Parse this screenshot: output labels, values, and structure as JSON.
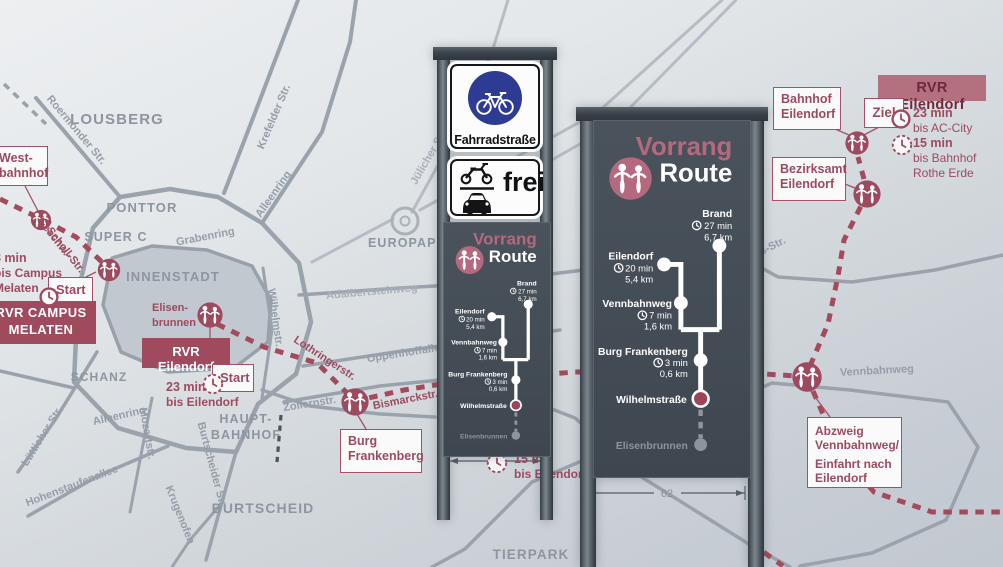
{
  "route": {
    "title_line1": "Vorrang",
    "title_line2": "Route",
    "stops": [
      {
        "name": "Brand",
        "time": "27 min",
        "dist": "6,7 km"
      },
      {
        "name": "Eilendorf",
        "time": "20 min",
        "dist": "5,4 km"
      },
      {
        "name": "Vennbahnweg",
        "time": "7 min",
        "dist": "1,6 km"
      },
      {
        "name": "Burg Frankenberg",
        "time": "3 min",
        "dist": "0,6 km"
      },
      {
        "name": "Wilhelmstraße"
      },
      {
        "name": "Elisenbrunnen"
      }
    ]
  },
  "signs": {
    "left": {
      "fahrradstrasse": "Fahrradstraße",
      "frei": "frei",
      "time_note": {
        "l1": "15 min",
        "l2": "bis Eilendorf"
      }
    },
    "right": {
      "dimension": "62"
    }
  },
  "map": {
    "areas": {
      "lousberg": "LOUSBERG",
      "ponttor": "PONTTOR",
      "super_c": "SUPER C",
      "innenstadt": "INNENSTADT",
      "europaplatz": "EUROPAPLATZ",
      "schanz": "SCHANZ",
      "hauptbahnhof_l1": "HAUPT-",
      "hauptbahnhof_l2": "BAHNHOF",
      "burtscheid": "BURTSCHEID",
      "tierpark": "TIERPARK"
    },
    "streets": {
      "roermonder": "Roermonder Str.",
      "krefelder": "Krefelder Str.",
      "alleenring_ne": "Alleenring",
      "grabenring": "Grabenring",
      "juelicher": "Jülicher Str.",
      "adalbertsteinweg": "Adalbertsteinweg",
      "oppenhoffallee": "Oppenhoffallee",
      "zollernstr": "Zollernstr.",
      "wilhelmstr": "Wilhelmstr.",
      "alleenring_s": "Alleenring",
      "luetticher": "Lütticher Str.",
      "hohenstaufenallee": "Hohenstaufenallee",
      "mozartstr": "Mozartstr.",
      "burtscheider": "Burtscheider Str.",
      "krugenofen": "Krugenofen",
      "vennbahnweg": "Vennbahnweg",
      "els_str": "els-Str.",
      "geschw_l1": "Geschw.-",
      "geschw_l2": "Scholl-Str.",
      "lothringerstr": "Lothringerstr.",
      "bismarckstr": "Bismarckstr."
    },
    "poi": {
      "elisenbrunnen_l1": "Elisen-",
      "elisenbrunnen_l2": "brunnen"
    },
    "boxes": {
      "westbahnhof_l1": "West-",
      "westbahnhof_l2": "bahnhof",
      "rvr_campus_l1": "RVR CAMPUS",
      "rvr_campus_l2": "MELATEN",
      "start_campus": "Start",
      "start_eilendorf": "Start",
      "rvr_eilendorf_center": "RVR Eilendorf",
      "burg_frankenberg_l1": "Burg",
      "burg_frankenberg_l2": "Frankenberg",
      "bahnhof_eilendorf_l1": "Bahnhof",
      "bahnhof_eilendorf_l2": "Eilendorf",
      "bezirksamt_l1": "Bezirksamt",
      "bezirksamt_l2": "Eilendorf",
      "rvr_eilendorf_badge": "RVR Eilendorf",
      "ziel": "Ziel",
      "abzweig_l1": "Abzweig",
      "abzweig_l2": "Vennbahnweg/",
      "abzweig_l3": "Einfahrt nach",
      "abzweig_l4": "Eilendorf"
    },
    "times": {
      "campus_l1": "8 min",
      "campus_l2": "bis Campus",
      "campus_l3": "Melaten",
      "eilendorf_l1": "23 min",
      "eilendorf_l2": "bis Eilendorf",
      "accity_l1": "23 min",
      "accity_l2": "bis AC-City",
      "rothe_l1": "15 min",
      "rothe_l2": "bis Bahnhof",
      "rothe_l3": "Rothe Erde"
    }
  },
  "colors": {
    "accent_maroon": "#9d4a5f",
    "accent_pink": "#b5697e",
    "sign_panel": "#454e57",
    "sign_blue": "#2e3b92"
  }
}
